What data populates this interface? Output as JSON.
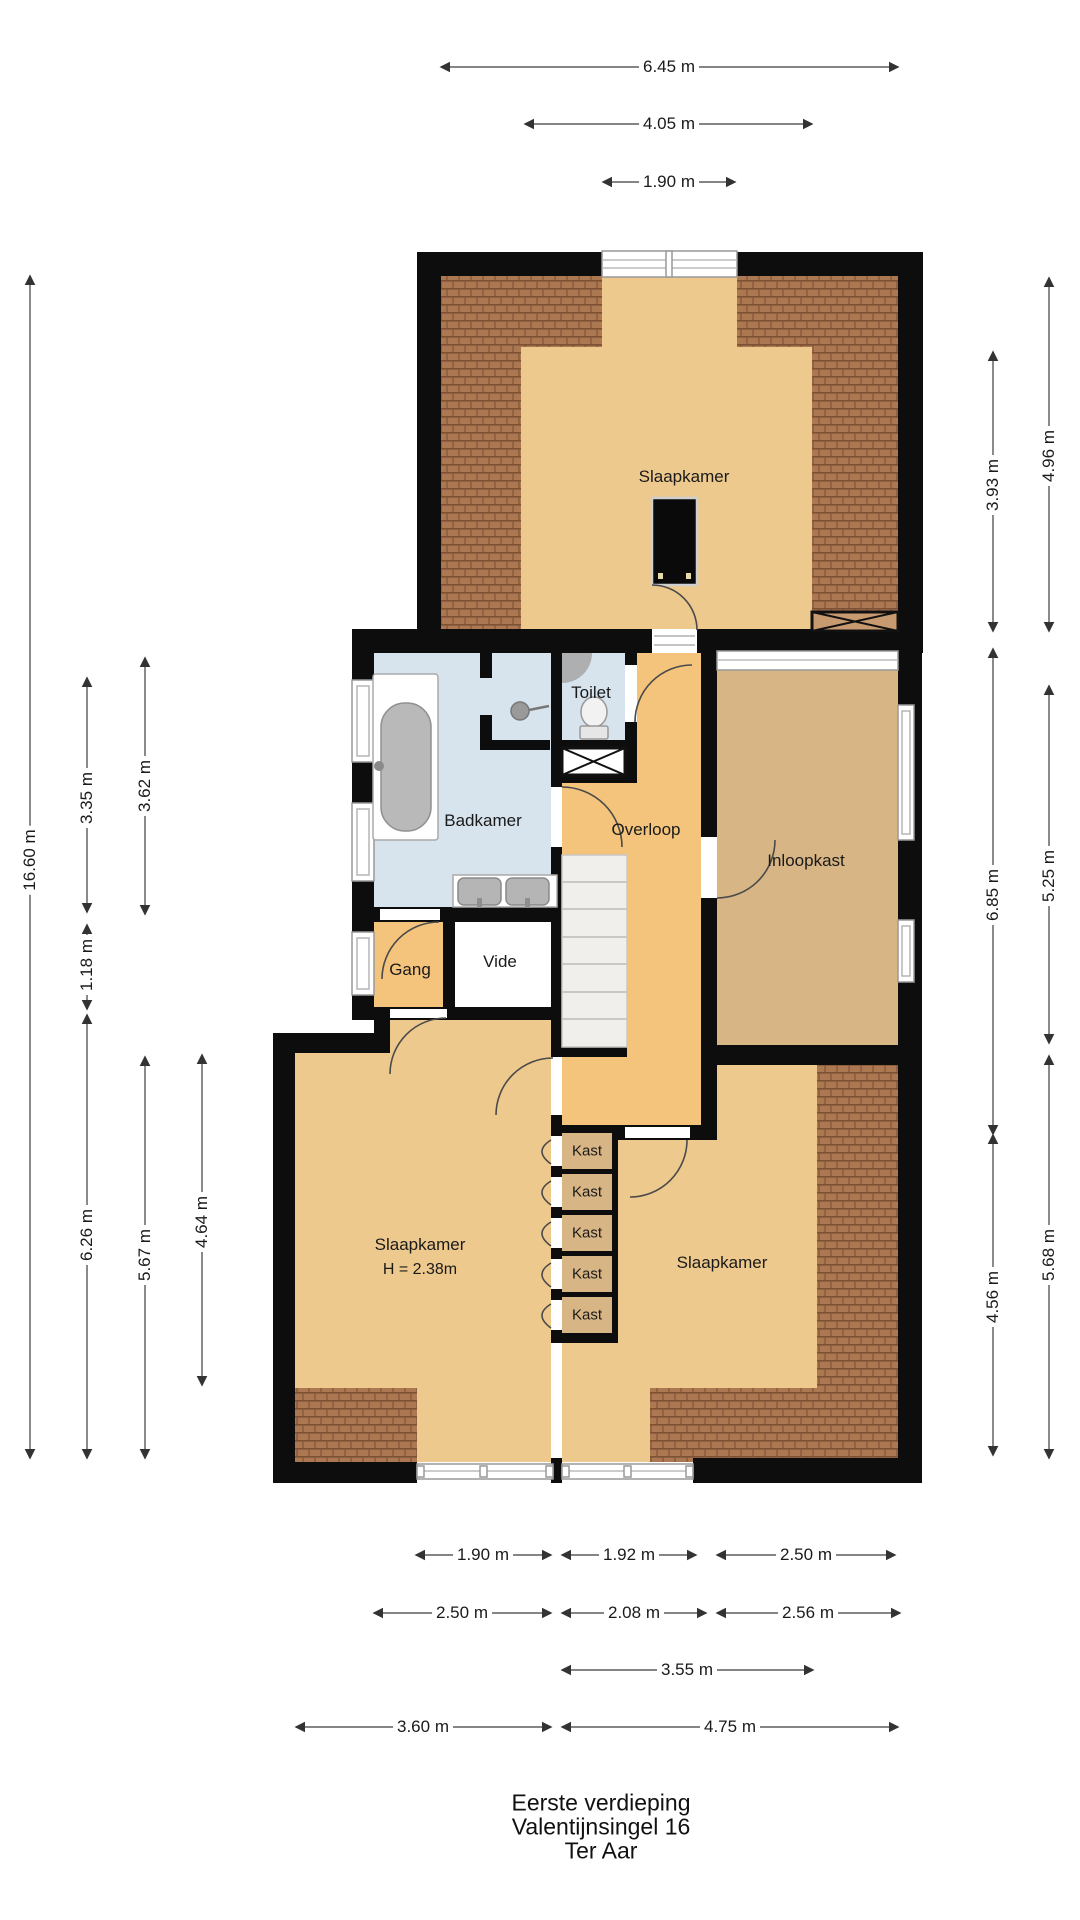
{
  "footer": {
    "lines": [
      "Eerste verdieping",
      "Valentijnsingel 16",
      "Ter Aar"
    ]
  },
  "rooms": {
    "bedroom_top": "Slaapkamer",
    "bathroom": "Badkamer",
    "toilet": "Toilet",
    "landing": "Overloop",
    "walk_in_closet": "Inloopkast",
    "hallway": "Gang",
    "void": "Vide",
    "bedroom_left": "Slaapkamer",
    "bedroom_left_height": "H = 2.38m",
    "bedroom_right": "Slaapkamer"
  },
  "closets": [
    "Kast",
    "Kast",
    "Kast",
    "Kast",
    "Kast"
  ],
  "dims": {
    "top": [
      "6.45 m",
      "4.05 m",
      "1.90 m"
    ],
    "left": [
      "16.60 m",
      "3.35 m",
      "3.62 m",
      "1.18 m",
      "6.26 m",
      "5.67 m",
      "4.64 m"
    ],
    "right": [
      "4.96 m",
      "3.93 m",
      "6.85 m",
      "5.25 m",
      "5.68 m",
      "4.56 m"
    ],
    "bottom": [
      "1.90 m",
      "1.92 m",
      "2.50 m",
      "2.50 m",
      "2.08 m",
      "2.56 m",
      "3.55 m",
      "3.60 m",
      "4.75 m"
    ]
  },
  "colors": {
    "wall": "#0d0d0d",
    "bedroom_floor": "#eec98d",
    "landing_floor": "#f4c47c",
    "closet_floor": "#d8b584",
    "bathroom_floor": "#d7e3ed",
    "roof_tile": "#ab7852",
    "roof_tile_line": "#7d5134",
    "stairs": "#f0efec",
    "window_frame": "#999999",
    "dimension_line": "#3c3c3c"
  }
}
